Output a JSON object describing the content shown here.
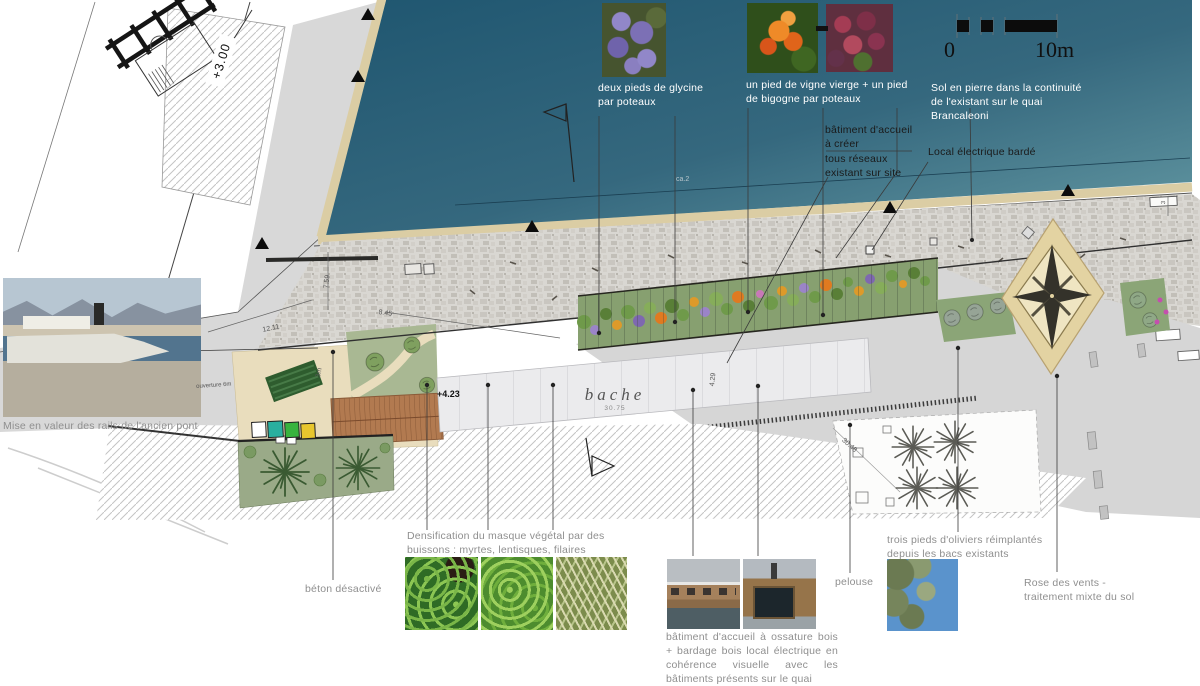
{
  "labels": {
    "glycine": "deux pieds de glycine par poteaux",
    "vigne": "un pied de vigne vierge + un pied de bigogne par poteaux",
    "sol_pierre": "Sol en pierre dans la continuité de l'existant sur le quai Brancaleoni",
    "batiment_creer_1": "bâtiment d'accueil à créer",
    "batiment_creer_2": "tous réseaux existant sur site",
    "local_electrique": "Local électrique bardé",
    "mise_en_valeur": "Mise en valeur des rails de l'ancien pont",
    "densification": "Densification du masque végétal par des buissons : myrtes, lentisques, filaires",
    "beton": "béton désactivé",
    "batiment_ossature": "bâtiment d'accueil à ossature bois + bardage bois local électrique en cohérence visuelle avec les bâtiments présents sur le quai",
    "pelouse": "pelouse",
    "oliviers": "trois pieds d'oliviers réimplantés depuis les bacs existants",
    "rose_des_vents": "Rose des vents - traitement mixte du sol"
  },
  "plan": {
    "bache": "bache",
    "bache_dim": "30.75",
    "level_quai": "+3.00",
    "level_esplanade": "+4.23",
    "dims": {
      "d759": "7.59",
      "d845": "8.45",
      "d1211": "12.11",
      "d3m": "3m",
      "d3048": "30.48",
      "d429": "4.29",
      "dca2": "ca.2",
      "ouverture": "ouverture 6m",
      "d3": "3"
    }
  },
  "scalebar": {
    "zero": "0",
    "ten": "10m"
  },
  "colors": {
    "water": "#2b6379",
    "quay_edge": "#dbcda4",
    "paving": "#d8d6d1",
    "lawn": "#93a583",
    "sand": "#e9ddbd",
    "wood": "#b27a50",
    "compass_sand": "#e3d3a2",
    "container_teal": "#2aaf9f",
    "container_green": "#37b33e",
    "container_yellow": "#e8c62e"
  }
}
